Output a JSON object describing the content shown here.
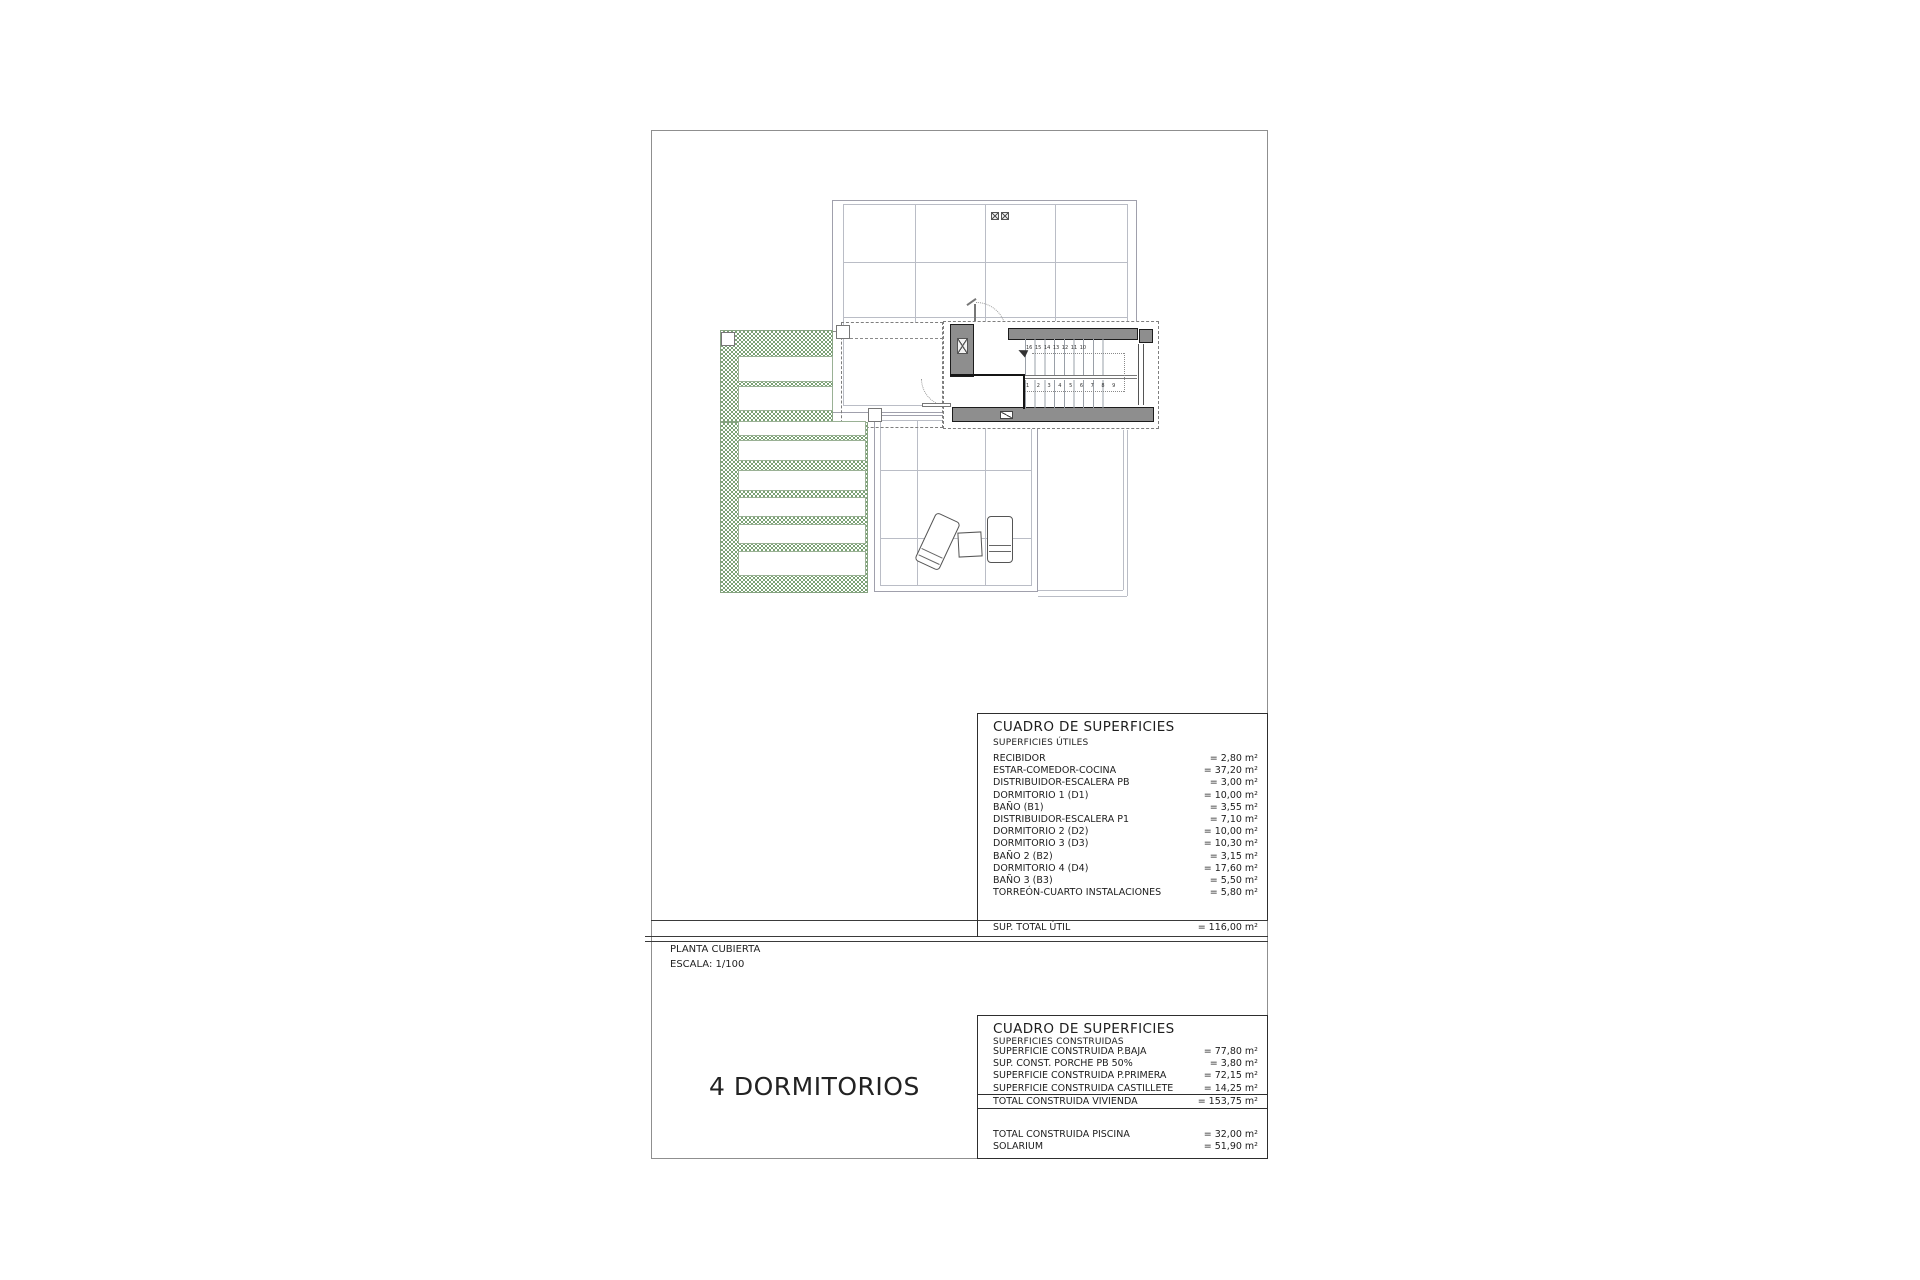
{
  "labels": {
    "plan_title": "PLANTA CUBIERTA",
    "plan_scale": "ESCALA: 1/100",
    "caption": "4 DORMITORIOS"
  },
  "tables": {
    "utiles": {
      "title": "CUADRO DE SUPERFICIES",
      "subtitle": "SUPERFICIES ÚTILES",
      "rows": [
        {
          "label": "RECIBIDOR",
          "value": "= 2,80 m²"
        },
        {
          "label": "ESTAR-COMEDOR-COCINA",
          "value": "= 37,20 m²"
        },
        {
          "label": "DISTRIBUIDOR-ESCALERA PB",
          "value": "= 3,00 m²"
        },
        {
          "label": "DORMITORIO 1 (D1)",
          "value": "= 10,00 m²"
        },
        {
          "label": "BAÑO  (B1)",
          "value": "= 3,55 m²"
        },
        {
          "label": "DISTRIBUIDOR-ESCALERA P1",
          "value": "= 7,10 m²"
        },
        {
          "label": "DORMITORIO 2 (D2)",
          "value": "= 10,00 m²"
        },
        {
          "label": "DORMITORIO 3 (D3)",
          "value": "= 10,30 m²"
        },
        {
          "label": "BAÑO 2 (B2)",
          "value": "= 3,15 m²"
        },
        {
          "label": "DORMITORIO 4 (D4)",
          "value": "= 17,60 m²"
        },
        {
          "label": "BAÑO 3 (B3)",
          "value": "= 5,50 m²"
        },
        {
          "label": "TORREÓN-CUARTO INSTALACIONES",
          "value": "= 5,80 m²"
        }
      ],
      "total": {
        "label": "SUP. TOTAL ÚTIL",
        "value": "= 116,00 m²"
      }
    },
    "construidas": {
      "title": "CUADRO DE SUPERFICIES",
      "subtitle": "SUPERFICIES CONSTRUIDAS",
      "rows": [
        {
          "label": "SUPERFICIE  CONSTRUIDA P.BAJA",
          "value": "= 77,80 m²"
        },
        {
          "label": "SUP. CONST. PORCHE PB 50%",
          "value": "= 3,80 m²"
        },
        {
          "label": "SUPERFICIE CONSTRUIDA P.PRIMERA",
          "value": "= 72,15 m²"
        },
        {
          "label": "SUPERFICIE CONSTRUIDA CASTILLETE",
          "value": "= 14,25 m²"
        }
      ],
      "total": {
        "label": "TOTAL CONSTRUIDA VIVIENDA",
        "value": "= 153,75 m²"
      },
      "extra": [
        {
          "label": "TOTAL CONSTRUIDA PISCINA",
          "value": "= 32,00 m²"
        },
        {
          "label": "SOLARIUM",
          "value": "= 51,90 m²"
        }
      ]
    }
  },
  "plan": {
    "stair_upper": "16 15 14 13 12 11 10",
    "stair_lower": "1 2 3 4 5 6 7 8 9"
  },
  "colors": {
    "pergola_green": "#7ba275",
    "wall_gray": "#8e8e8e",
    "line_gray": "#a9a9b6",
    "frame_gray": "#8f8f8f",
    "table_border": "#2e2e2e"
  }
}
